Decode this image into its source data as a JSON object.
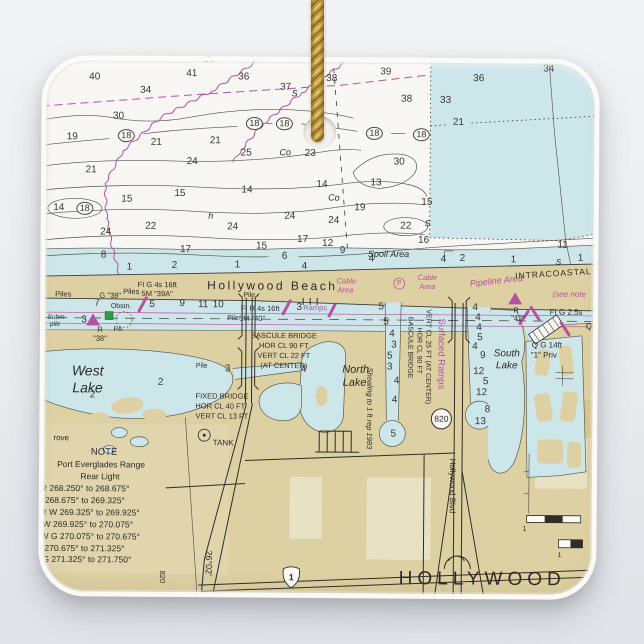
{
  "ornament": {
    "type_label": "square ceramic ornament with hanging cord",
    "cord_colors": {
      "light": "#e7cc74",
      "mid": "#c2a045",
      "dark": "#8a6a22"
    }
  },
  "chart": {
    "colors": {
      "paper": "#f9f7f3",
      "water": "#cde6ea",
      "land": "#ddd0a2",
      "landlight": "#e9e1c3",
      "landdark": "#d3c289",
      "magenta": "#b5519f",
      "ink": "#2e2b27",
      "green": "#2e9c46"
    },
    "texts": [
      {
        "t": "Co",
        "x": 207,
        "y": 60,
        "s": 9,
        "i": 1
      },
      {
        "t": "S",
        "x": 293,
        "y": 94,
        "s": 9,
        "i": 1
      },
      {
        "t": "Co",
        "x": 284,
        "y": 153,
        "s": 9,
        "i": 1
      },
      {
        "t": "Co",
        "x": 333,
        "y": 198,
        "s": 9,
        "i": 1
      },
      {
        "t": "h",
        "x": 210,
        "y": 217,
        "s": 9,
        "i": 1
      },
      {
        "t": "S",
        "x": 427,
        "y": 223,
        "s": 9,
        "i": 1
      },
      {
        "t": "S",
        "x": 558,
        "y": 261,
        "s": 8,
        "i": 1
      },
      {
        "t": "Spoil Area",
        "x": 388,
        "y": 254,
        "s": 9,
        "i": 1
      },
      {
        "t": "Hollywood Beach",
        "x": 272,
        "y": 286,
        "s": 12,
        "sp": 2.5
      },
      {
        "t": "Cable",
        "x": 346,
        "y": 281,
        "s": 7.5,
        "c": "m",
        "i": 1
      },
      {
        "t": "Area",
        "x": 345,
        "y": 290,
        "s": 7.5,
        "c": "m",
        "i": 1
      },
      {
        "t": "P",
        "x": 399,
        "y": 283,
        "s": 7,
        "c": "m"
      },
      {
        "t": "Cable",
        "x": 427,
        "y": 277,
        "s": 7.5,
        "c": "m",
        "i": 1
      },
      {
        "t": "Area",
        "x": 427,
        "y": 286,
        "s": 7.5,
        "c": "m",
        "i": 1
      },
      {
        "t": "Pipeline Area",
        "x": 496,
        "y": 280,
        "s": 9,
        "c": "m",
        "i": 1,
        "r": -7
      },
      {
        "t": "INTRACOASTAL",
        "x": 553,
        "y": 272,
        "s": 8.5,
        "sp": 1,
        "r": -4
      },
      {
        "t": "(see note",
        "x": 569,
        "y": 293,
        "s": 8,
        "c": "m",
        "i": 1
      },
      {
        "t": "Piles",
        "x": 63,
        "y": 296,
        "s": 7.5
      },
      {
        "t": "G \"39\"",
        "x": 110,
        "y": 297,
        "s": 7.5
      },
      {
        "t": "Piles",
        "x": 131,
        "y": 293,
        "s": 7.5
      },
      {
        "t": "FI G 4s 16ft",
        "x": 157,
        "y": 286,
        "s": 7.5
      },
      {
        "t": "5M \"39A\"",
        "x": 157,
        "y": 295,
        "s": 7.5
      },
      {
        "t": "Obstn.",
        "x": 121,
        "y": 308,
        "s": 7
      },
      {
        "t": "PA",
        "x": 118,
        "y": 331,
        "s": 7
      },
      {
        "t": "R",
        "x": 100,
        "y": 331,
        "s": 7.5
      },
      {
        "t": "\"38\"",
        "x": 100,
        "y": 340,
        "s": 7.5
      },
      {
        "t": "Subm",
        "x": 56,
        "y": 320,
        "s": 6.5,
        "i": 1
      },
      {
        "t": "pile",
        "x": 55,
        "y": 327,
        "s": 6.5,
        "i": 1
      },
      {
        "t": "Pile",
        "x": 249,
        "y": 296,
        "s": 7
      },
      {
        "t": "FI R 4s 16ft",
        "x": 260,
        "y": 309,
        "s": 7.5
      },
      {
        "t": "Pile",
        "x": 233,
        "y": 319,
        "s": 7
      },
      {
        "t": "5M \"40\"",
        "x": 252,
        "y": 319,
        "s": 7.5
      },
      {
        "t": "Ramps",
        "x": 315,
        "y": 308,
        "s": 7.5,
        "c": "m"
      },
      {
        "t": "BASCULE BRIDGE",
        "x": 284,
        "y": 336,
        "s": 7.5
      },
      {
        "t": "HOR CL 90 FT",
        "x": 284,
        "y": 346,
        "s": 7.5
      },
      {
        "t": "VERT CL 22 FT",
        "x": 284,
        "y": 356,
        "s": 7.5
      },
      {
        "t": "(AT CENTER)",
        "x": 284,
        "y": 366,
        "s": 7.5
      },
      {
        "t": "West",
        "x": 88,
        "y": 372,
        "s": 14,
        "i": 1
      },
      {
        "t": "Lake",
        "x": 88,
        "y": 389,
        "s": 14,
        "i": 1
      },
      {
        "t": "Pile",
        "x": 202,
        "y": 367,
        "s": 7
      },
      {
        "t": "FIXED BRIDGE",
        "x": 196,
        "y": 397,
        "s": 7.5,
        "a": "l"
      },
      {
        "t": "HOR CL 40 FT",
        "x": 196,
        "y": 407,
        "s": 7.5,
        "a": "l"
      },
      {
        "t": "VERT CL 13 FT",
        "x": 196,
        "y": 417,
        "s": 7.5,
        "a": "l"
      },
      {
        "t": "rove",
        "x": 62,
        "y": 440,
        "s": 8
      },
      {
        "t": "TANK",
        "x": 224,
        "y": 444,
        "s": 8
      },
      {
        "t": "NOTE",
        "x": 105,
        "y": 454,
        "s": 9.5
      },
      {
        "t": "Port Everglades Range",
        "x": 102,
        "y": 466,
        "s": 8.5
      },
      {
        "t": "Rear Light",
        "x": 101,
        "y": 478,
        "s": 8.5
      },
      {
        "t": "R 268.250° to 268.675°",
        "x": 42,
        "y": 490,
        "s": 8.5,
        "a": "l"
      },
      {
        "t": "268.675° to 269.325°",
        "x": 46,
        "y": 502,
        "s": 8.5,
        "a": "l"
      },
      {
        "t": "R W 269.325° to 269.925°",
        "x": 42,
        "y": 514,
        "s": 8.5,
        "a": "l"
      },
      {
        "t": "W 269.925° to 270.075°",
        "x": 44,
        "y": 526,
        "s": 8.5,
        "a": "l"
      },
      {
        "t": "W G 270.075° to 270.675°",
        "x": 42,
        "y": 538,
        "s": 8.5,
        "a": "l"
      },
      {
        "t": "270.675° to 271.325°",
        "x": 46,
        "y": 550,
        "s": 8.5,
        "a": "l"
      },
      {
        "t": "G 271.325° to 271.750°",
        "x": 44,
        "y": 561,
        "s": 8.5,
        "a": "l"
      },
      {
        "t": "North",
        "x": 356,
        "y": 370,
        "s": 11,
        "i": 1
      },
      {
        "t": "Lake",
        "x": 355,
        "y": 383,
        "s": 11,
        "i": 1
      },
      {
        "t": "South",
        "x": 507,
        "y": 353,
        "s": 10,
        "i": 1
      },
      {
        "t": "Lake",
        "x": 507,
        "y": 365,
        "s": 10,
        "i": 1
      },
      {
        "t": "R",
        "x": 516,
        "y": 309,
        "s": 7.5
      },
      {
        "t": "\"42\"",
        "x": 518,
        "y": 317,
        "s": 7.5
      },
      {
        "t": "FI G 2.5s",
        "x": 566,
        "y": 311,
        "s": 8
      },
      {
        "t": "Q",
        "x": 589,
        "y": 325,
        "s": 8
      },
      {
        "t": "Q G 14ft",
        "x": 547,
        "y": 344,
        "s": 8
      },
      {
        "t": "\"1\" Priv",
        "x": 544,
        "y": 354,
        "s": 8
      },
      {
        "t": "HOLLYWOOD",
        "x": 484,
        "y": 578,
        "s": 19,
        "sp": 5
      },
      {
        "t": "820",
        "x": 442,
        "y": 418,
        "s": 8.5
      },
      {
        "t": "1",
        "x": 293,
        "y": 578,
        "s": 9,
        "w": 1
      },
      {
        "t": "1",
        "x": 526,
        "y": 528,
        "s": 7
      },
      {
        "t": "1",
        "x": 561,
        "y": 554,
        "s": 7
      },
      {
        "t": "Surfaced Ramps",
        "x": 441,
        "y": 353,
        "s": 9.5,
        "c": "m",
        "r": 90
      },
      {
        "t": "BASCULE BRIDGE",
        "x": 410,
        "y": 347,
        "s": 7,
        "r": 90
      },
      {
        "t": "HOR CL 90 FT",
        "x": 419,
        "y": 350,
        "s": 7,
        "r": 90
      },
      {
        "t": "VERT CL 25 FT (AT CENTER)",
        "x": 428,
        "y": 356,
        "s": 7,
        "r": 90
      },
      {
        "t": "Shoaling to 1 ft rep 1983",
        "x": 370,
        "y": 408,
        "s": 7.5,
        "i": 1,
        "r": 90
      },
      {
        "t": "Hollywood Blvd",
        "x": 453,
        "y": 485,
        "s": 8,
        "r": 90
      },
      {
        "t": "26°02'",
        "x": 210,
        "y": 564,
        "s": 9,
        "r": 90
      },
      {
        "t": "820",
        "x": 164,
        "y": 578,
        "s": 7.5,
        "r": 90
      }
    ],
    "depths": [
      {
        "t": "40",
        "x": 93,
        "y": 79
      },
      {
        "t": "41",
        "x": 190,
        "y": 75
      },
      {
        "t": "36",
        "x": 242,
        "y": 78
      },
      {
        "t": "34",
        "x": 144,
        "y": 92
      },
      {
        "t": "37",
        "x": 284,
        "y": 88
      },
      {
        "t": "38",
        "x": 330,
        "y": 79
      },
      {
        "t": "39",
        "x": 384,
        "y": 72
      },
      {
        "t": "36",
        "x": 477,
        "y": 78
      },
      {
        "t": "34",
        "x": 547,
        "y": 68
      },
      {
        "t": "38",
        "x": 405,
        "y": 99
      },
      {
        "t": "33",
        "x": 444,
        "y": 100
      },
      {
        "t": "21",
        "x": 457,
        "y": 122
      },
      {
        "t": "30",
        "x": 117,
        "y": 118
      },
      {
        "t": "19",
        "x": 71,
        "y": 139
      },
      {
        "t": "21",
        "x": 155,
        "y": 144
      },
      {
        "t": "21",
        "x": 214,
        "y": 142
      },
      {
        "t": "24",
        "x": 191,
        "y": 163
      },
      {
        "t": "25",
        "x": 245,
        "y": 154
      },
      {
        "t": "23",
        "x": 309,
        "y": 154
      },
      {
        "t": "30",
        "x": 398,
        "y": 162
      },
      {
        "t": "21",
        "x": 90,
        "y": 172
      },
      {
        "t": "15",
        "x": 126,
        "y": 201
      },
      {
        "t": "15",
        "x": 179,
        "y": 195
      },
      {
        "t": "14",
        "x": 246,
        "y": 191
      },
      {
        "t": "14",
        "x": 321,
        "y": 185
      },
      {
        "t": "13",
        "x": 375,
        "y": 183
      },
      {
        "t": "19",
        "x": 359,
        "y": 208
      },
      {
        "t": "15",
        "x": 426,
        "y": 202
      },
      {
        "t": "14",
        "x": 58,
        "y": 210
      },
      {
        "t": "24",
        "x": 105,
        "y": 234
      },
      {
        "t": "22",
        "x": 150,
        "y": 228
      },
      {
        "t": "24",
        "x": 232,
        "y": 228
      },
      {
        "t": "24",
        "x": 289,
        "y": 217
      },
      {
        "t": "24",
        "x": 333,
        "y": 221
      },
      {
        "t": "22",
        "x": 405,
        "y": 226
      },
      {
        "t": "17",
        "x": 302,
        "y": 240
      },
      {
        "t": "17",
        "x": 185,
        "y": 251
      },
      {
        "t": "15",
        "x": 261,
        "y": 247
      },
      {
        "t": "12",
        "x": 327,
        "y": 244
      },
      {
        "t": "9",
        "x": 342,
        "y": 251
      },
      {
        "t": "6",
        "x": 284,
        "y": 257
      },
      {
        "t": "16",
        "x": 423,
        "y": 240
      },
      {
        "t": "11",
        "x": 562,
        "y": 244
      },
      {
        "t": "8",
        "x": 103,
        "y": 257
      },
      {
        "t": "18",
        "x": 125,
        "y": 137,
        "c": 1
      },
      {
        "t": "18",
        "x": 253,
        "y": 124,
        "c": 1
      },
      {
        "t": "18",
        "x": 283,
        "y": 124,
        "c": 1
      },
      {
        "t": "18",
        "x": 373,
        "y": 133,
        "c": 1
      },
      {
        "t": "18",
        "x": 420,
        "y": 134,
        "c": 1
      },
      {
        "t": "18",
        "x": 591,
        "y": 70,
        "c": 1
      },
      {
        "t": "18",
        "x": 84,
        "y": 210,
        "c": 1
      },
      {
        "t": "1",
        "x": 129,
        "y": 269
      },
      {
        "t": "2",
        "x": 174,
        "y": 267
      },
      {
        "t": "1",
        "x": 237,
        "y": 266
      },
      {
        "t": "4",
        "x": 304,
        "y": 267
      },
      {
        "t": "4",
        "x": 371,
        "y": 259
      },
      {
        "t": "4",
        "x": 443,
        "y": 259
      },
      {
        "t": "2",
        "x": 462,
        "y": 258
      },
      {
        "t": "1",
        "x": 513,
        "y": 259
      },
      {
        "t": "1",
        "x": 580,
        "y": 257
      },
      {
        "t": "7",
        "x": 97,
        "y": 305
      },
      {
        "t": "3",
        "x": 84,
        "y": 322
      },
      {
        "t": "5",
        "x": 152,
        "y": 306
      },
      {
        "t": "9",
        "x": 182,
        "y": 305
      },
      {
        "t": "11",
        "x": 203,
        "y": 306
      },
      {
        "t": "10",
        "x": 218,
        "y": 306
      },
      {
        "t": "3",
        "x": 299,
        "y": 308
      },
      {
        "t": "3",
        "x": 228,
        "y": 370
      },
      {
        "t": "4",
        "x": 304,
        "y": 370
      },
      {
        "t": "2",
        "x": 161,
        "y": 384
      },
      {
        "t": "2",
        "x": 93,
        "y": 397
      },
      {
        "t": "5",
        "x": 381,
        "y": 307
      },
      {
        "t": "5",
        "x": 386,
        "y": 322
      },
      {
        "t": "4",
        "x": 392,
        "y": 334
      },
      {
        "t": "3",
        "x": 394,
        "y": 345
      },
      {
        "t": "5",
        "x": 390,
        "y": 356
      },
      {
        "t": "3",
        "x": 390,
        "y": 367
      },
      {
        "t": "4",
        "x": 397,
        "y": 381
      },
      {
        "t": "4",
        "x": 395,
        "y": 400
      },
      {
        "t": "5",
        "x": 394,
        "y": 434
      },
      {
        "t": "4",
        "x": 475,
        "y": 307
      },
      {
        "t": "4",
        "x": 478,
        "y": 317
      },
      {
        "t": "4",
        "x": 479,
        "y": 327
      },
      {
        "t": "5",
        "x": 480,
        "y": 337
      },
      {
        "t": "4",
        "x": 475,
        "y": 346
      },
      {
        "t": "9",
        "x": 483,
        "y": 355
      },
      {
        "t": "12",
        "x": 479,
        "y": 371
      },
      {
        "t": "5",
        "x": 486,
        "y": 381
      },
      {
        "t": "12",
        "x": 482,
        "y": 392
      },
      {
        "t": "8",
        "x": 488,
        "y": 409
      },
      {
        "t": "13",
        "x": 481,
        "y": 421
      }
    ]
  }
}
